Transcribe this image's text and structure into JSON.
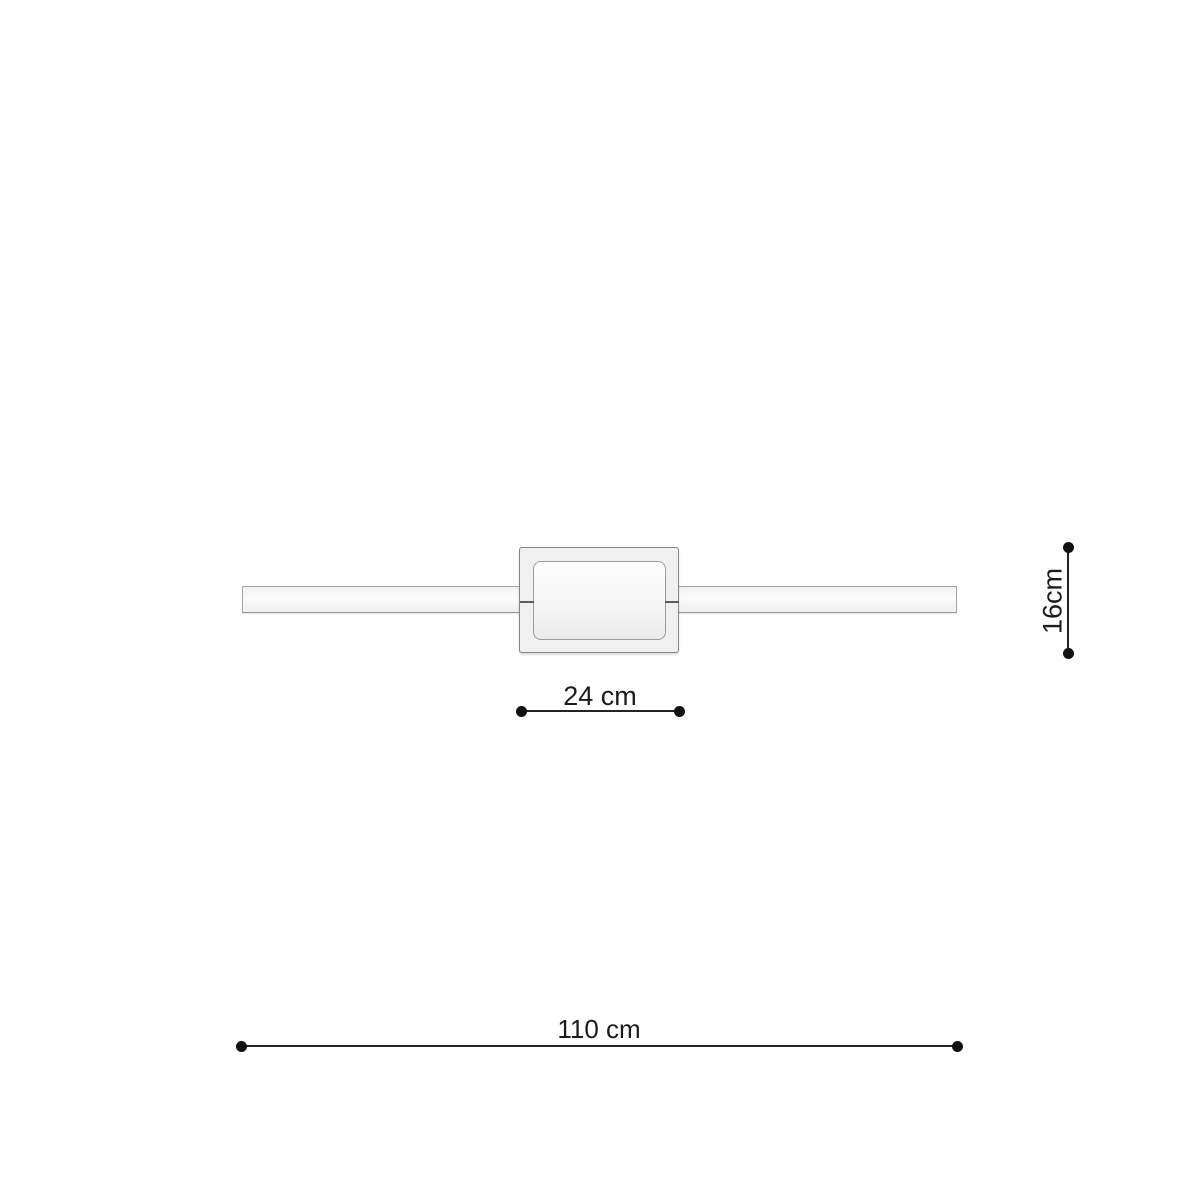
{
  "diagram": {
    "kind": "wall-lamp-dimension-drawing",
    "colors": {
      "background": "#ffffff",
      "dimension_line": "#1b1b1b",
      "bar_fill": "#f7f7f7",
      "bar_border": "#a6a6a6",
      "plate_fill": "#f1f0ef",
      "plate_border": "#868686",
      "panel_fill": "#f6f6f6",
      "panel_border": "#9c9c9c"
    },
    "dimensions": {
      "box_width": {
        "label": "24 cm",
        "value_cm": 24
      },
      "box_height": {
        "label": "16cm",
        "value_cm": 16
      },
      "total_length": {
        "label": "110 cm",
        "value_cm": 110
      }
    }
  }
}
